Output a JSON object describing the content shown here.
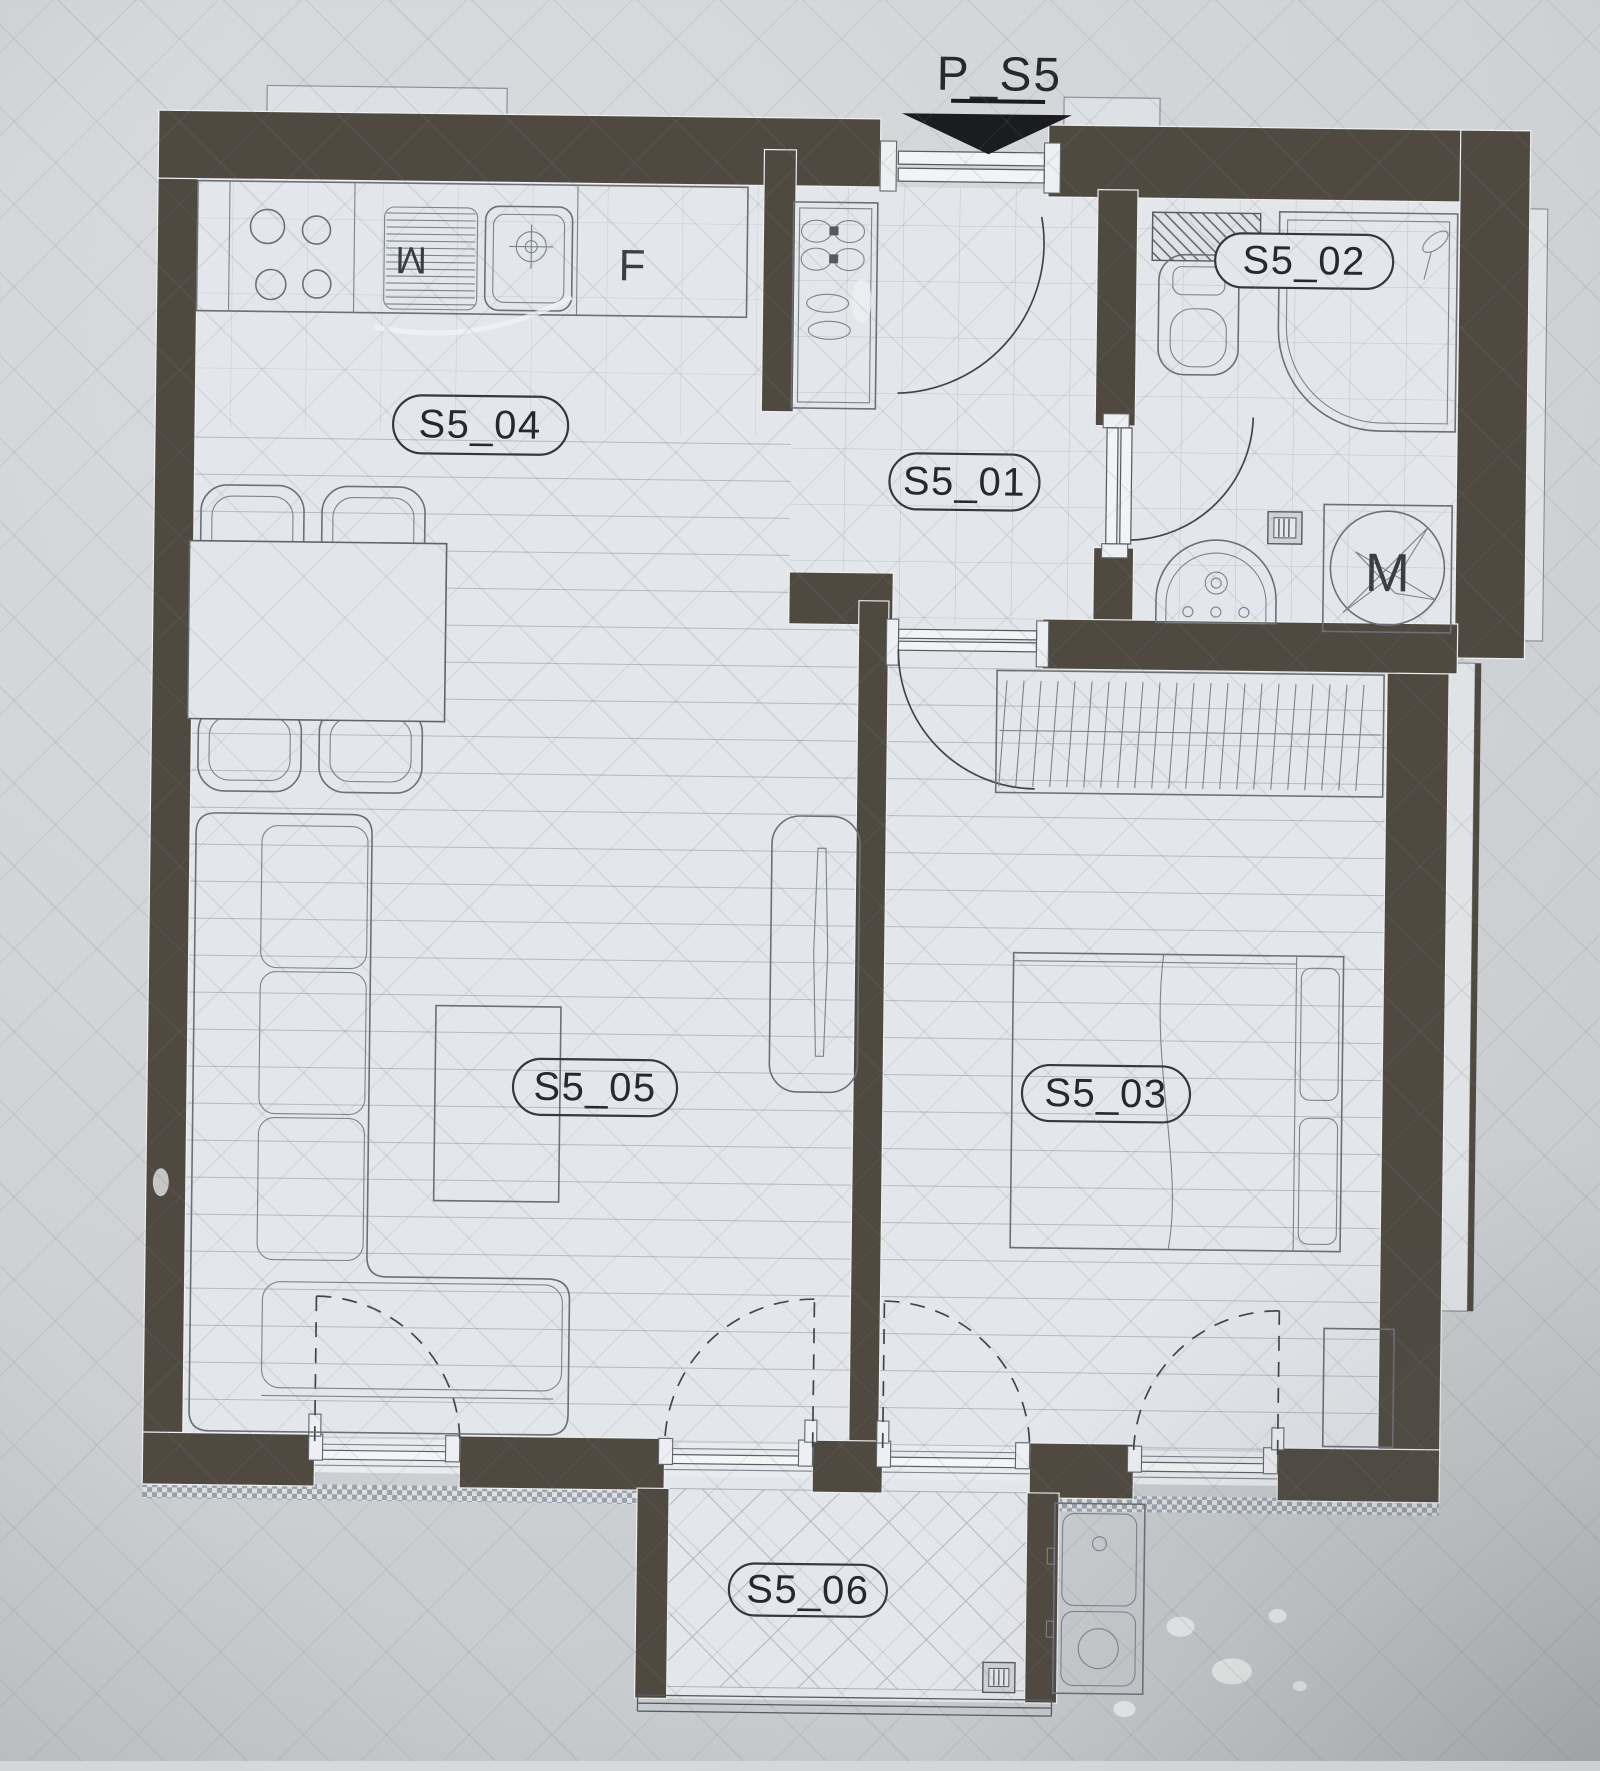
{
  "colors": {
    "wall": "#4f4940",
    "paper": "#d0d3d6",
    "floor": "#e3e6ea",
    "line": "#6b7077",
    "ink": "#25282d"
  },
  "section_marker": {
    "label": "P_S5"
  },
  "room_labels": {
    "s5_01": "S5_01",
    "s5_02": "S5_02",
    "s5_03": "S5_03",
    "s5_04": "S5_04",
    "s5_05": "S5_05",
    "s5_06": "S5_06"
  },
  "kitchen": {
    "drainer_label": "M",
    "fridge_label": "F"
  },
  "bathroom": {
    "washing_machine_label": "M"
  }
}
